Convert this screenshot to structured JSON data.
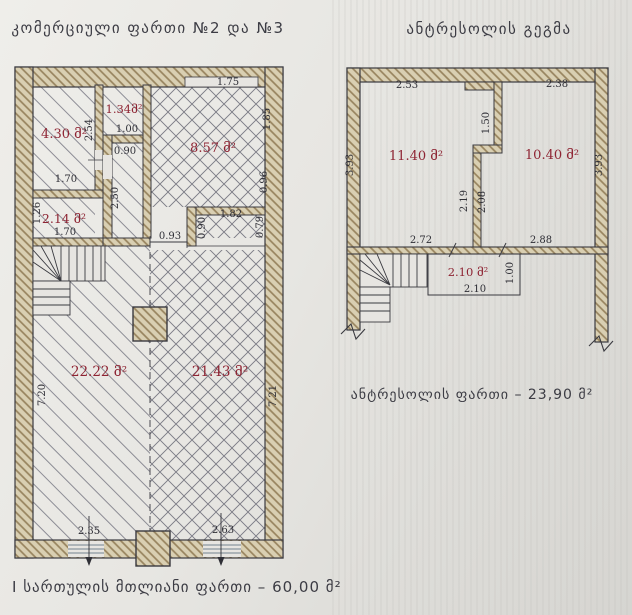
{
  "page": {
    "title_left": "კომერციული ფართი №2 და №3",
    "title_right": "ანტრესოლის გეგმა",
    "footer_total": "I სართულის მთლიანი ფართი – 60,00 მ²",
    "mezzanine_total": "ანტრესოლის ფართი – 23,90 მ²",
    "colors": {
      "wall_fill": "#d9cfb2",
      "wall_hatch_line": "#97835e",
      "outline": "#3a3a40",
      "room_label": "#8e2433",
      "dim_text": "#2f2f36",
      "window": "#8a96a0",
      "paper": "#e7e5e1"
    }
  },
  "left_plan": {
    "rooms": [
      {
        "label": "4.30 მ²"
      },
      {
        "label": "1.34მ²"
      },
      {
        "label": "2.14 მ²"
      },
      {
        "label": "8.57 მ²"
      },
      {
        "label": "22.22 მ²"
      },
      {
        "label": "21.43 მ²"
      }
    ],
    "dims": [
      "2.54",
      "1.00",
      "0.90",
      "1.70",
      "2.50",
      "1.26",
      "1.70",
      "1.75",
      "1.85",
      "0.96",
      "1.82",
      "0.79",
      "0.90",
      "0.93",
      "7.20",
      "7.21",
      "2.35",
      "2.63"
    ]
  },
  "right_plan": {
    "rooms": [
      {
        "label": "11.40 მ²"
      },
      {
        "label": "10.40 მ²"
      },
      {
        "label": "2.10 მ²"
      }
    ],
    "dims": [
      "2.53",
      "2.38",
      "3.93",
      "3.93",
      "1.50",
      "2.19",
      "2.08",
      "2.72",
      "2.88",
      "2.10",
      "1.00"
    ]
  }
}
